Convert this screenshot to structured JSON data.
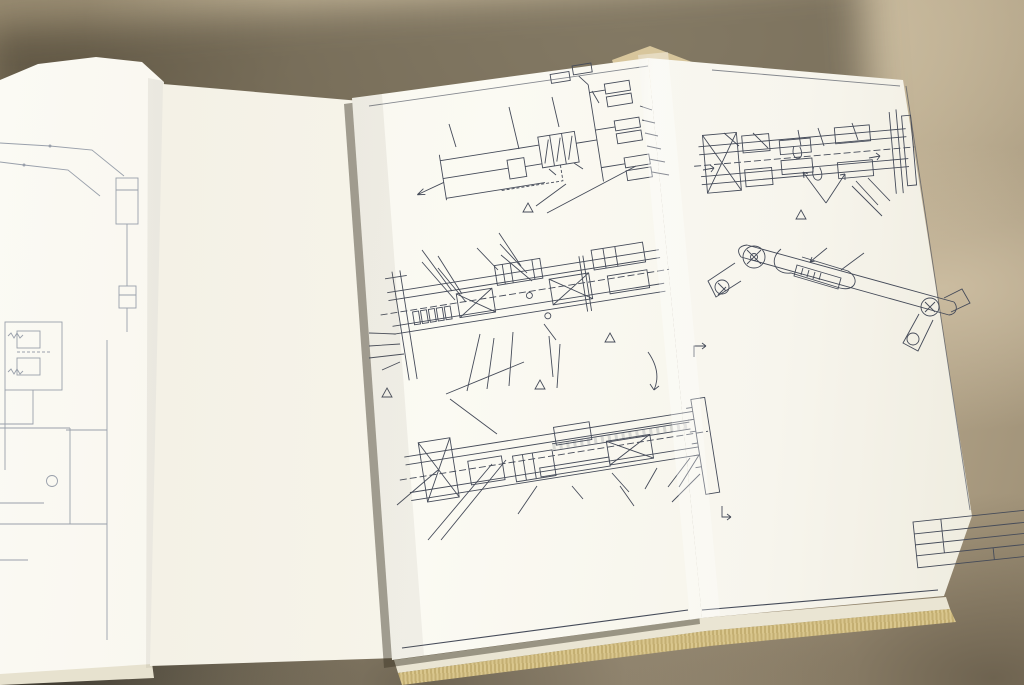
{
  "document_type": "photograph of open equipment manual with hydraulic blueprint foldout",
  "colors": {
    "ink": "#454b59",
    "pencil": "#8f95a1",
    "paper": "#f7f5ec",
    "table": "#b6a88c",
    "page_edges": "#d9c68d"
  },
  "labels": [
    {
      "id": "left-gripper-cylinder",
      "text": "GRIPPER CYLINDER"
    },
    {
      "id": "left-push-cylinder",
      "text": "PUSH\nCYLINDER"
    },
    {
      "id": "left-to-truck",
      "text": "TO TRUCK",
      "u": 1
    },
    {
      "id": "left-grip-pull",
      "text": "GRIP-PULL"
    },
    {
      "id": "left-sequence-valve",
      "text": "SEQUENCE\nVALVE"
    },
    {
      "id": "left-manifold",
      "text": "MANIFOLD"
    },
    {
      "id": "left-pencil-note",
      "text": "Hydraulic Schematic"
    },
    {
      "id": "sch-title",
      "text": "HYDRAULIC SCHEMATIC",
      "u": 1
    },
    {
      "id": "sch-to-truck",
      "text": "TO TRUCK"
    },
    {
      "id": "sch-open-push",
      "text": "OPEN/PUSH"
    },
    {
      "id": "sch-manifold",
      "text": "MANIFOLD"
    },
    {
      "id": "sch-grip-pull",
      "text": "GRIP/PULL"
    },
    {
      "id": "sch-seq-valve",
      "text": "SEQUENCE\nVALVE"
    },
    {
      "id": "sch-push-cyls",
      "text": "PUSH CYLS"
    },
    {
      "id": "sch-gripper-cyls",
      "text": "GRIPPER CYLS"
    },
    {
      "id": "sch-note-middle",
      "text": "THIS HOSE MUST RUN\nDOWN THE MIDDLE"
    },
    {
      "id": "rm-base",
      "text": "BASE"
    },
    {
      "id": "rm-torque-tube",
      "text": "TORQUE TUBE"
    },
    {
      "id": "rm-title",
      "text": "PARTIAL TOP VIEW\nROTARY MANIFOLD HOSING",
      "u": 1
    },
    {
      "id": "rm-note-tie",
      "text": "HEAD OF TIE\nWRAP TO THIS\nSIDE OF HOSES"
    },
    {
      "id": "rm-note-under",
      "text": "THIS HOSE TO RUN\nUNDER ITEM 43 AS\nSHOWN, AND NOT\nBESIDE IT."
    },
    {
      "id": "sv-hold-down",
      "text": "HOSE\nHOLD DOWN\nBAR"
    },
    {
      "id": "sv-push-rack",
      "text": "PUSH\nRACK"
    },
    {
      "id": "sv-title",
      "text": "PARTIAL TOP VIEW\nSEQUENCE VALVE HOSING",
      "u": 1
    },
    {
      "id": "sv-b-top",
      "text": "B"
    },
    {
      "id": "sv-b-bottom",
      "text": "B"
    },
    {
      "id": "cy-title",
      "text": "PARTIAL TOP VIEW\nCYLINDER HOSING",
      "u": 1
    },
    {
      "id": "cy-note-loops",
      "text": "EQUAL LOOPS\nBOTH SIDES"
    },
    {
      "id": "cy-a-left",
      "text": "A"
    },
    {
      "id": "cy-a-right",
      "text": "A"
    },
    {
      "id": "aa-hose-clip",
      "text": "HOSE CLIP"
    },
    {
      "id": "aa-title",
      "text": "PARTIAL VIEW A-A",
      "u": 1
    },
    {
      "id": "notes-title",
      "text": "NOTES:",
      "u": 1
    },
    {
      "id": "cl-symbol",
      "text": "¢"
    },
    {
      "id": "tb-no",
      "text": "-46"
    },
    {
      "id": "tb-company",
      "text": "BRUDI EQUIPMENT, IN"
    },
    {
      "id": "tb-group",
      "text": "HYDRAULIC GROU"
    },
    {
      "id": "tb-model",
      "text": "CHALLENGER"
    },
    {
      "id": "tb-sheet",
      "text": "SHEET 1 OF 2"
    }
  ],
  "parts_list": {
    "rows": [
      {
        "no": "1",
        "qty": "1",
        "part": "A40628",
        "name": "SEQUENCE VALVE"
      },
      {
        "no": "2",
        "qty": "1",
        "part": "29946.05",
        "name": "ADAPTER"
      },
      {
        "no": "3",
        "qty": "1",
        "part": "33108.0333",
        "name": "HOSE ASS'Y"
      },
      {
        "no": "4",
        "qty": "1",
        "part": "33108.0366",
        "name": "HOSE ASS'Y"
      },
      {
        "no": "5",
        "qty": "1",
        "part": "33108.0358",
        "name": "HOSE ASS'Y"
      },
      {
        "no": "6",
        "qty": "4",
        "part": "IC.0508",
        "name": "BOLT"
      },
      {
        "no": "7",
        "qty": "6",
        "part": "4E.05",
        "name": "LOCKWASHER"
      },
      {
        "no": "8",
        "qty": "8",
        "part": "29946.05",
        "name": "TEE FITTING"
      },
      {
        "no": "9",
        "qty": "3",
        "part": "29946.05",
        "name": "BULKHEAD TEE"
      },
      {
        "no": "10",
        "qty": "2",
        "part": "31188.05",
        "name": "ROTARY MANIFOLD"
      },
      {
        "no": "11",
        "qty": "1",
        "part": "A41261",
        "name": "BOLT"
      },
      {
        "no": "12",
        "qty": "2",
        "part": "IC.0532",
        "name": "ESNA NUT"
      },
      {
        "no": "13",
        "qty": "2",
        "part": "I50.10",
        "name": "BULKHEAD ELBOW"
      },
      {
        "no": "14",
        "qty": "2",
        "part": "31184.05",
        "name": "HOSE ASS'Y"
      },
      {
        "no": "15",
        "qty": "1",
        "part": "33108.0290",
        "name": "HOSE ASS'Y"
      },
      {
        "no": "16",
        "qty": "1",
        "part": "33108.0382",
        "name": "HOSE ASS'Y"
      },
      {
        "no": "17",
        "qty": "1",
        "part": "33309.0230",
        "name": "HOSE ASS'Y"
      },
      {
        "no": "18",
        "qty": "1",
        "part": "33309.0108",
        "name": "HOSE ASS'Y"
      },
      {
        "no": "19",
        "qty": "2",
        "part": "29944.05",
        "name": "O'RING ELBOW"
      },
      {
        "no": "20",
        "qty": "1",
        "part": "33108.0356",
        "name": "HOSE ASS'Y"
      },
      {
        "no": "21",
        "qty": "1",
        "part": "32912.0080",
        "name": "HOSE WRAP"
      },
      {
        "no": "22",
        "qty": "1",
        "part": "32912.0170",
        "name": "HOSE WRAP"
      },
      {
        "no": "23",
        "qty": "1",
        "part": "32912.0290",
        "name": "HOSE WRAP"
      },
      {
        "no": "24",
        "qty": "2",
        "part": "31880.012",
        "name": "ROLL PIN"
      },
      {
        "no": "25",
        "qty": "2",
        "part": "A36136",
        "name": "WASHER"
      },
      {
        "no": "26",
        "qty": "2",
        "part": "C36046",
        "name": "CYL ASS'Y"
      },
      {
        "no": "27",
        "qty": "8",
        "part": "IC.0820",
        "name": "BOLT"
      },
      {
        "no": "28",
        "qty": "8",
        "part": "4E.08",
        "name": "LOCKWASHER"
      },
      {
        "no": "29",
        "qty": "1",
        "part": "33141.0470",
        "name": "HOSE ASSY"
      },
      {
        "no": "30",
        "qty": "1",
        "part": "33141.0425",
        "name": "HOSE ASS'Y"
      },
      {
        "no": "31",
        "qty": "2",
        "part": "IC.0428",
        "name": "BOLT"
      },
      {
        "no": "32",
        "qty": "2",
        "part": "I70.04",
        "name": "ESNA NUT"
      },
      {
        "no": "33",
        "qty": "1",
        "part": "40429.1",
        "name": "JAW"
      },
      {
        "no": "34",
        "qty": "1",
        "part": "40430.1",
        "name": "GRIPPER BAR"
      },
      {
        "no": "35",
        "qty": "1",
        "part": "36053.01",
        "name": "SHOE"
      },
      {
        "no": "36",
        "qty": "1",
        "part": "A24877",
        "name": "TIE WRAP"
      },
      {
        "no": "37",
        "qty": "1",
        "part": "32912.0400",
        "name": "HOSE WRAP"
      },
      {
        "no": "38",
        "qty": "1",
        "part": "33141.0475",
        "name": "HOSE ASS'Y"
      },
      {
        "no": "39",
        "qty": "1",
        "part": "33141.0420",
        "name": "HOSE ASS'Y"
      },
      {
        "no": "40",
        "qty": "2",
        "part": "33458.05",
        "name": "FITTING CAP"
      },
      {
        "no": "41",
        "qty": "2",
        "part": "IC.0612",
        "name": "BOLT"
      },
      {
        "no": "42",
        "qty": "2",
        "part": "4E.06",
        "name": "LOCKWASHER"
      },
      {
        "no": "43",
        "qty": "1",
        "part": "32912.0260",
        "name": "HOSE WRAP"
      }
    ]
  },
  "notes": {
    "items": [
      {
        "num": "1",
        "lines": [
          "BEND HOSE CLIP OVER HOSE TO SECURE",
          "AGAINST FRONT PUSH ARM OR PUSH RACK"
        ]
      },
      {
        "num": "2",
        "lines": [
          "START HOSE WRAP FROM THE END OF",
          "THE SWAGE FITTING, AS SHOWN"
        ]
      },
      {
        "num": "3",
        "lines": [
          "WRAP ENTIRE HOSE (2 PLACES)"
        ]
      },
      {
        "num": "4",
        "lines": [
          "START HOSE WRAP ABOVE HOSE CLIP ON",
          "PUSH RACK (SEE SHEET 2)"
        ],
        "gap": 1
      },
      {
        "num": "5",
        "lines": [
          "TIGHTEN HOSE FITTINGS BEFORE TIGHTENING",
          "ROTARY MANIFOLD AND SEQUENCE VALVE",
          "BOLTS"
        ],
        "u": "BEFORE"
      },
      {
        "num": "6",
        "lines": [
          "LOCATE HOSE TIE ON CENTERLINE (¢)",
          "AS SHOWN"
        ]
      }
    ]
  },
  "callouts": {
    "schematic": [
      "4",
      "5",
      "3",
      "9",
      "15",
      "4",
      "8",
      "18",
      "17",
      "4",
      "17",
      "36",
      "37"
    ],
    "manifold": [
      "2",
      "2",
      "21",
      "15",
      "19",
      "14",
      "13",
      "22",
      "7",
      "11",
      "10",
      "9",
      "5",
      "2",
      "35",
      "6"
    ],
    "seqvalve": [
      "5",
      "40",
      "41",
      "1",
      "42",
      "4",
      "2",
      "36",
      "3",
      "4"
    ],
    "cyl": [
      "8",
      "4",
      "18",
      "17",
      "4",
      "20",
      "19",
      "6"
    ],
    "aa": [
      "16",
      "1"
    ]
  }
}
